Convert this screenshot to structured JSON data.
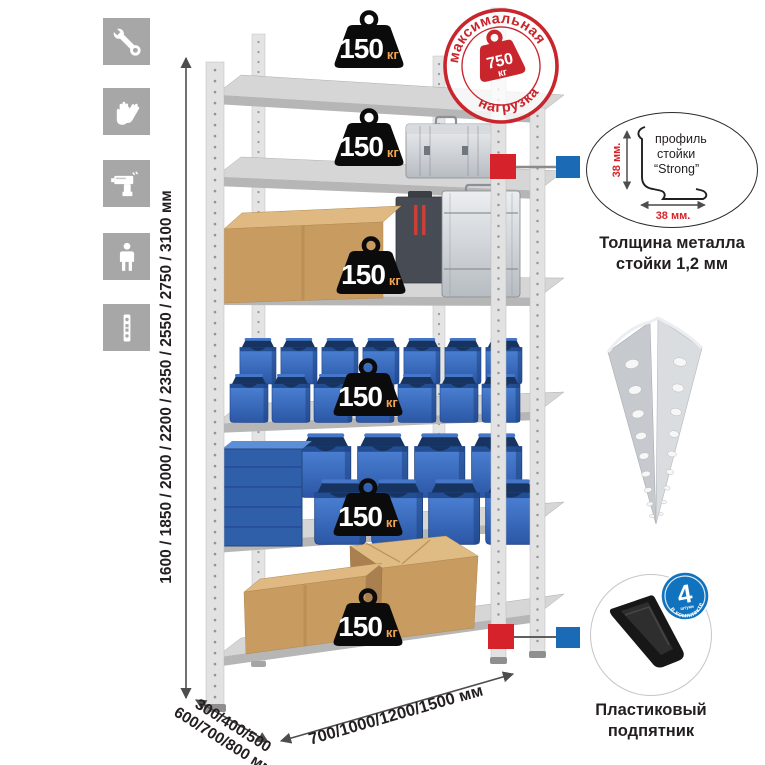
{
  "rack": {
    "shelf_count": 6,
    "load_value": "150",
    "load_unit": "кг",
    "height_options": "1600 / 1850 / 2000 / 2200 / 2350 / 2550 / 2750 / 3100 мм",
    "depth_options_line1": "300/400/500",
    "depth_options_line2": "600/700/800 мм",
    "width_options": "700/1000/1200/1500 мм"
  },
  "max_load_stamp": {
    "arc_top": "максимальная",
    "arc_bottom": "нагрузка",
    "value": "750",
    "unit": "кг"
  },
  "profile_detail": {
    "label_line1": "профиль",
    "label_line2": "стойки",
    "label_line3": "“Strong”",
    "dim_vertical": "38 мм.",
    "dim_horizontal": "38 мм.",
    "caption_line1": "Толщина металла",
    "caption_line2": "стойки 1,2 мм"
  },
  "foot_detail": {
    "badge_value": "4",
    "badge_sub": "штуки",
    "badge_arc": "в комплекте",
    "caption_line1": "Пластиковый",
    "caption_line2": "подпятник"
  },
  "sidebar": {
    "icons": [
      "wrench",
      "gloves",
      "drill",
      "person",
      "upright-strip"
    ]
  },
  "colors": {
    "stamp_red": "#c9252c",
    "callout_red": "#d6222a",
    "callout_blue": "#1b6ab5",
    "badge_blue": "#1173bd",
    "bin_blue": "#3567b4",
    "icon_gray": "#a7a7a7",
    "metal_gray": "#d8d8d8",
    "cardboard": "#c89b60",
    "text_dark": "#231f20"
  }
}
